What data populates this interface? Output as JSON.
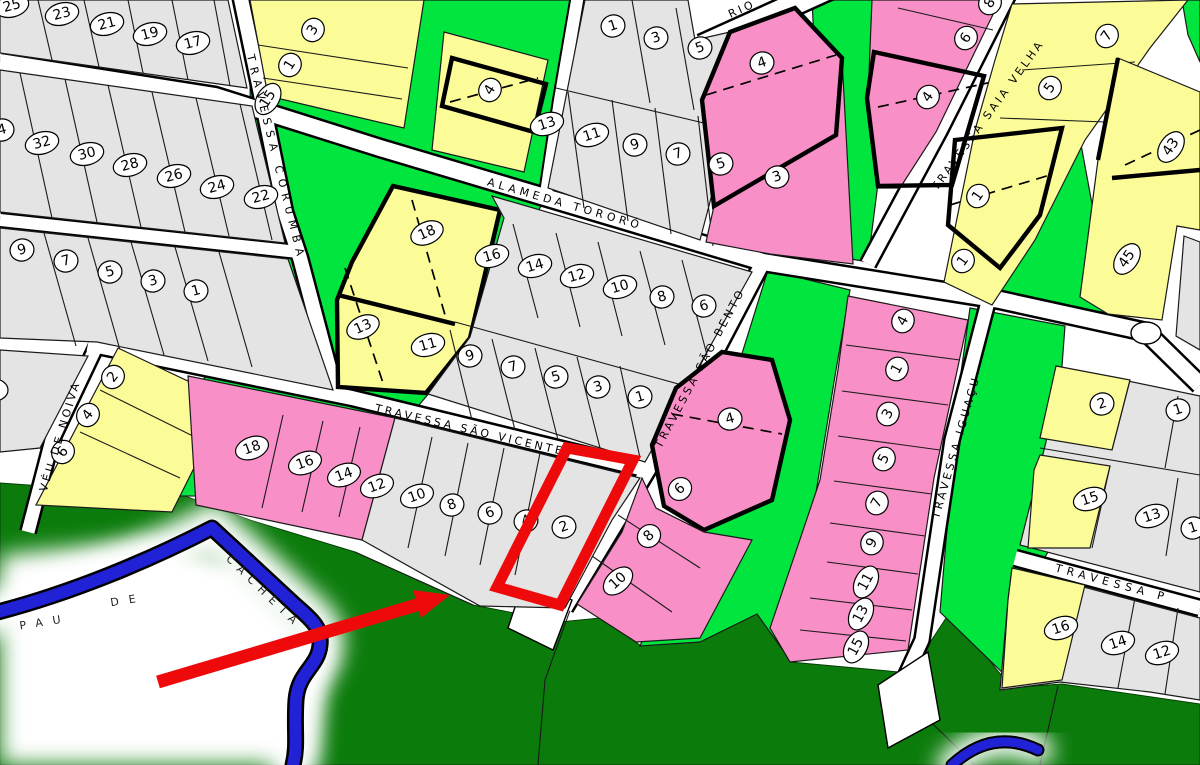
{
  "map": {
    "type": "cadastral-allotment-plan",
    "streets": [
      {
        "id": "corumba",
        "name": "TRAVESSA CORUMBÁ",
        "x": 276,
        "y": 158,
        "rot": 76,
        "ls": 6,
        "fs": 11
      },
      {
        "id": "tororo",
        "name": "ALAMEDA TORORÓ",
        "x": 565,
        "y": 204,
        "rot": 16,
        "ls": 4,
        "fs": 12
      },
      {
        "id": "sao-vicente",
        "name": "TRAVESSA SÃO VICENTE",
        "x": 470,
        "y": 430,
        "rot": 13,
        "ls": 3,
        "fs": 11
      },
      {
        "id": "sao-bento",
        "name": "TRAVESSA SÃO BENTO",
        "x": 700,
        "y": 368,
        "rot": -62,
        "ls": 3,
        "fs": 11
      },
      {
        "id": "saia-velha",
        "name": "TRAVESSA SAIA VELHA",
        "x": 988,
        "y": 115,
        "rot": -54,
        "ls": 3,
        "fs": 11
      },
      {
        "id": "iguacu",
        "name": "TRAVESSA IGUAÇU",
        "x": 956,
        "y": 447,
        "rot": -74,
        "ls": 3,
        "fs": 11
      },
      {
        "id": "veu-de-noiva",
        "name": "VÉU DE NOIVA",
        "x": 60,
        "y": 436,
        "rot": -73,
        "ls": 3,
        "fs": 11
      },
      {
        "id": "rio-partial",
        "name": "RIO",
        "x": 742,
        "y": 9,
        "rot": -24,
        "ls": 3,
        "fs": 11
      },
      {
        "id": "travessa-p",
        "name": "TRAVESSA P",
        "x": 1112,
        "y": 583,
        "rot": 15,
        "ls": 5,
        "fs": 11
      }
    ],
    "river": {
      "name_words": [
        {
          "text": "PAU",
          "x": 45,
          "y": 622,
          "rot": -9,
          "ls": 10
        },
        {
          "text": "DE",
          "x": 128,
          "y": 600,
          "rot": -9,
          "ls": 10
        },
        {
          "text": "CACHETA",
          "x": 264,
          "y": 592,
          "rot": 44,
          "ls": 7
        }
      ]
    },
    "lots": [
      {
        "n": "25",
        "x": 12,
        "y": 6,
        "r": -15
      },
      {
        "n": "23",
        "x": 62,
        "y": 14,
        "r": -15
      },
      {
        "n": "21",
        "x": 107,
        "y": 24,
        "r": -15
      },
      {
        "n": "19",
        "x": 150,
        "y": 34,
        "r": -15
      },
      {
        "n": "17",
        "x": 193,
        "y": 43,
        "r": -15
      },
      {
        "n": "4",
        "x": 2,
        "y": 130,
        "r": -15
      },
      {
        "n": "32",
        "x": 42,
        "y": 143,
        "r": -15
      },
      {
        "n": "30",
        "x": 87,
        "y": 154,
        "r": -15
      },
      {
        "n": "28",
        "x": 130,
        "y": 165,
        "r": -15
      },
      {
        "n": "26",
        "x": 174,
        "y": 176,
        "r": -15
      },
      {
        "n": "24",
        "x": 217,
        "y": 187,
        "r": -15
      },
      {
        "n": "22",
        "x": 261,
        "y": 197,
        "r": -15
      },
      {
        "n": "9",
        "x": 22,
        "y": 250,
        "r": -15
      },
      {
        "n": "7",
        "x": 66,
        "y": 261,
        "r": -15
      },
      {
        "n": "5",
        "x": 110,
        "y": 272,
        "r": -15
      },
      {
        "n": "3",
        "x": 153,
        "y": 281,
        "r": -15
      },
      {
        "n": "1",
        "x": 196,
        "y": 291,
        "r": -15
      },
      {
        "n": "3",
        "x": 313,
        "y": 30,
        "r": -58
      },
      {
        "n": "1",
        "x": 290,
        "y": 65,
        "r": -58
      },
      {
        "n": "15",
        "x": 268,
        "y": 99,
        "r": -58
      },
      {
        "n": "2",
        "x": 113,
        "y": 377,
        "r": -52
      },
      {
        "n": "4",
        "x": 88,
        "y": 415,
        "r": -52
      },
      {
        "n": "6",
        "x": 63,
        "y": 452,
        "r": -52
      },
      {
        "n": "18",
        "x": 427,
        "y": 233,
        "r": -24
      },
      {
        "n": "13",
        "x": 363,
        "y": 327,
        "r": -24
      },
      {
        "n": "4",
        "x": 490,
        "y": 90,
        "r": -58
      },
      {
        "n": "1",
        "x": 613,
        "y": 26,
        "r": -18
      },
      {
        "n": "3",
        "x": 656,
        "y": 38,
        "r": -18
      },
      {
        "n": "5",
        "x": 700,
        "y": 48,
        "r": -18
      },
      {
        "n": "13",
        "x": 547,
        "y": 124,
        "r": -18
      },
      {
        "n": "11",
        "x": 592,
        "y": 135,
        "r": -18
      },
      {
        "n": "9",
        "x": 635,
        "y": 145,
        "r": -18
      },
      {
        "n": "7",
        "x": 678,
        "y": 154,
        "r": -18
      },
      {
        "n": "5",
        "x": 721,
        "y": 164,
        "r": -18
      },
      {
        "n": "4",
        "x": 762,
        "y": 63,
        "r": -18
      },
      {
        "n": "3",
        "x": 777,
        "y": 177,
        "r": -18
      },
      {
        "n": "16",
        "x": 492,
        "y": 256,
        "r": -16
      },
      {
        "n": "14",
        "x": 535,
        "y": 266,
        "r": -16
      },
      {
        "n": "12",
        "x": 577,
        "y": 276,
        "r": -16
      },
      {
        "n": "10",
        "x": 620,
        "y": 287,
        "r": -16
      },
      {
        "n": "8",
        "x": 662,
        "y": 297,
        "r": -16
      },
      {
        "n": "6",
        "x": 704,
        "y": 306,
        "r": -16
      },
      {
        "n": "11",
        "x": 428,
        "y": 345,
        "r": -16
      },
      {
        "n": "9",
        "x": 470,
        "y": 356,
        "r": -16
      },
      {
        "n": "7",
        "x": 513,
        "y": 367,
        "r": -16
      },
      {
        "n": "5",
        "x": 556,
        "y": 377,
        "r": -16
      },
      {
        "n": "3",
        "x": 598,
        "y": 387,
        "r": -16
      },
      {
        "n": "1",
        "x": 640,
        "y": 397,
        "r": -16
      },
      {
        "n": "18",
        "x": 252,
        "y": 448,
        "r": -20
      },
      {
        "n": "16",
        "x": 305,
        "y": 463,
        "r": -20
      },
      {
        "n": "14",
        "x": 344,
        "y": 475,
        "r": -20
      },
      {
        "n": "12",
        "x": 377,
        "y": 486,
        "r": -20
      },
      {
        "n": "10",
        "x": 417,
        "y": 496,
        "r": -20
      },
      {
        "n": "8",
        "x": 452,
        "y": 505,
        "r": -20
      },
      {
        "n": "6",
        "x": 490,
        "y": 513,
        "r": -20
      },
      {
        "n": "4",
        "x": 526,
        "y": 521,
        "r": -20
      },
      {
        "n": "2",
        "x": 564,
        "y": 527,
        "r": -20
      },
      {
        "n": "4",
        "x": 730,
        "y": 419,
        "r": -15
      },
      {
        "n": "6",
        "x": 680,
        "y": 489,
        "r": -42
      },
      {
        "n": "8",
        "x": 649,
        "y": 536,
        "r": -42
      },
      {
        "n": "10",
        "x": 618,
        "y": 581,
        "r": -42
      },
      {
        "n": "4",
        "x": 903,
        "y": 321,
        "r": -62
      },
      {
        "n": "1",
        "x": 897,
        "y": 369,
        "r": -62
      },
      {
        "n": "3",
        "x": 888,
        "y": 414,
        "r": -62
      },
      {
        "n": "5",
        "x": 884,
        "y": 459,
        "r": -62
      },
      {
        "n": "7",
        "x": 877,
        "y": 503,
        "r": -62
      },
      {
        "n": "9",
        "x": 872,
        "y": 543,
        "r": -62
      },
      {
        "n": "11",
        "x": 866,
        "y": 582,
        "r": -62
      },
      {
        "n": "13",
        "x": 861,
        "y": 614,
        "r": -62
      },
      {
        "n": "15",
        "x": 856,
        "y": 647,
        "r": -62
      },
      {
        "n": "8",
        "x": 990,
        "y": 3,
        "r": -55
      },
      {
        "n": "6",
        "x": 966,
        "y": 38,
        "r": -55
      },
      {
        "n": "4",
        "x": 928,
        "y": 97,
        "r": -55
      },
      {
        "n": "7",
        "x": 1107,
        "y": 36,
        "r": -55
      },
      {
        "n": "5",
        "x": 1050,
        "y": 88,
        "r": -55
      },
      {
        "n": "1",
        "x": 978,
        "y": 196,
        "r": -55
      },
      {
        "n": "1",
        "x": 963,
        "y": 261,
        "r": -55
      },
      {
        "n": "43",
        "x": 1171,
        "y": 147,
        "r": -55
      },
      {
        "n": "45",
        "x": 1127,
        "y": 259,
        "r": -55
      },
      {
        "n": "2",
        "x": 1102,
        "y": 404,
        "r": -18
      },
      {
        "n": "1",
        "x": 1178,
        "y": 410,
        "r": -18
      },
      {
        "n": "15",
        "x": 1090,
        "y": 499,
        "r": -18
      },
      {
        "n": "13",
        "x": 1152,
        "y": 516,
        "r": -18
      },
      {
        "n": "1",
        "x": 1193,
        "y": 528,
        "r": -18
      },
      {
        "n": "16",
        "x": 1061,
        "y": 628,
        "r": -18
      },
      {
        "n": "14",
        "x": 1118,
        "y": 643,
        "r": -18
      },
      {
        "n": "12",
        "x": 1162,
        "y": 653,
        "r": -18
      }
    ],
    "annotations": {
      "highlighted_lot": "2",
      "highlight_shape": "red rectangle outline around lot 2 south of Travessa São Vicente",
      "arrow": "red arrow pointing from lower-left toward the highlighted lot"
    },
    "colors": {
      "parcel_gray": "#E4E4E4",
      "parcel_yellow": "#FBFB98",
      "parcel_pink": "#F98FC7",
      "green_strip": "#00E63E",
      "forest_dark_green": "#0B7B0B",
      "river_blue": "#2121D6",
      "road_white": "#FFFFFF",
      "line_black": "#000000",
      "annotation_red": "#EE0A0A"
    }
  }
}
